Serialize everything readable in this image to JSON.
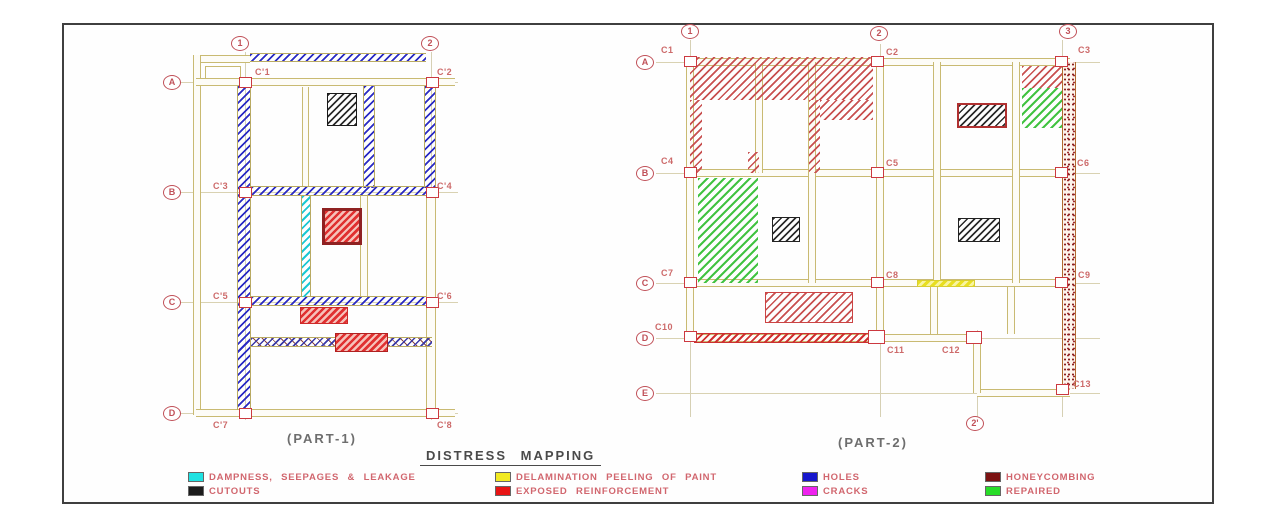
{
  "part1": {
    "label": "(PART-1)",
    "col_bubbles": [
      "1",
      "2"
    ],
    "row_bubbles": [
      "A",
      "B",
      "C",
      "D"
    ],
    "column_labels": [
      "C'1",
      "C'2",
      "C'3",
      "C'4",
      "C'5",
      "C'6",
      "C'7",
      "C'8"
    ]
  },
  "part2": {
    "label": "(PART-2)",
    "col_bubbles": [
      "1",
      "2",
      "3"
    ],
    "bottom_bubble": "2'",
    "row_bubbles": [
      "A",
      "B",
      "C",
      "D",
      "E"
    ],
    "column_labels": [
      "C1",
      "C2",
      "C3",
      "C4",
      "C5",
      "C6",
      "C7",
      "C8",
      "C9",
      "C10",
      "C11",
      "C12",
      "C13"
    ]
  },
  "title": "DISTRESS MAPPING",
  "legend": {
    "items": [
      {
        "label": "DAMPNESS, SEEPAGES & LEAKAGE",
        "color": "#1fe2e2"
      },
      {
        "label": "CUTOUTS",
        "color": "#1c1c1c"
      },
      {
        "label": "DELAMINATION PEELING OF PAINT",
        "color": "#f2ea22"
      },
      {
        "label": "EXPOSED REINFORCEMENT",
        "color": "#e81414"
      },
      {
        "label": "HOLES",
        "color": "#1616cc"
      },
      {
        "label": "CRACKS",
        "color": "#ee22ee"
      },
      {
        "label": "HONEYCOMBING",
        "color": "#7c1212"
      },
      {
        "label": "REPAIRED",
        "color": "#28dd28"
      }
    ]
  }
}
